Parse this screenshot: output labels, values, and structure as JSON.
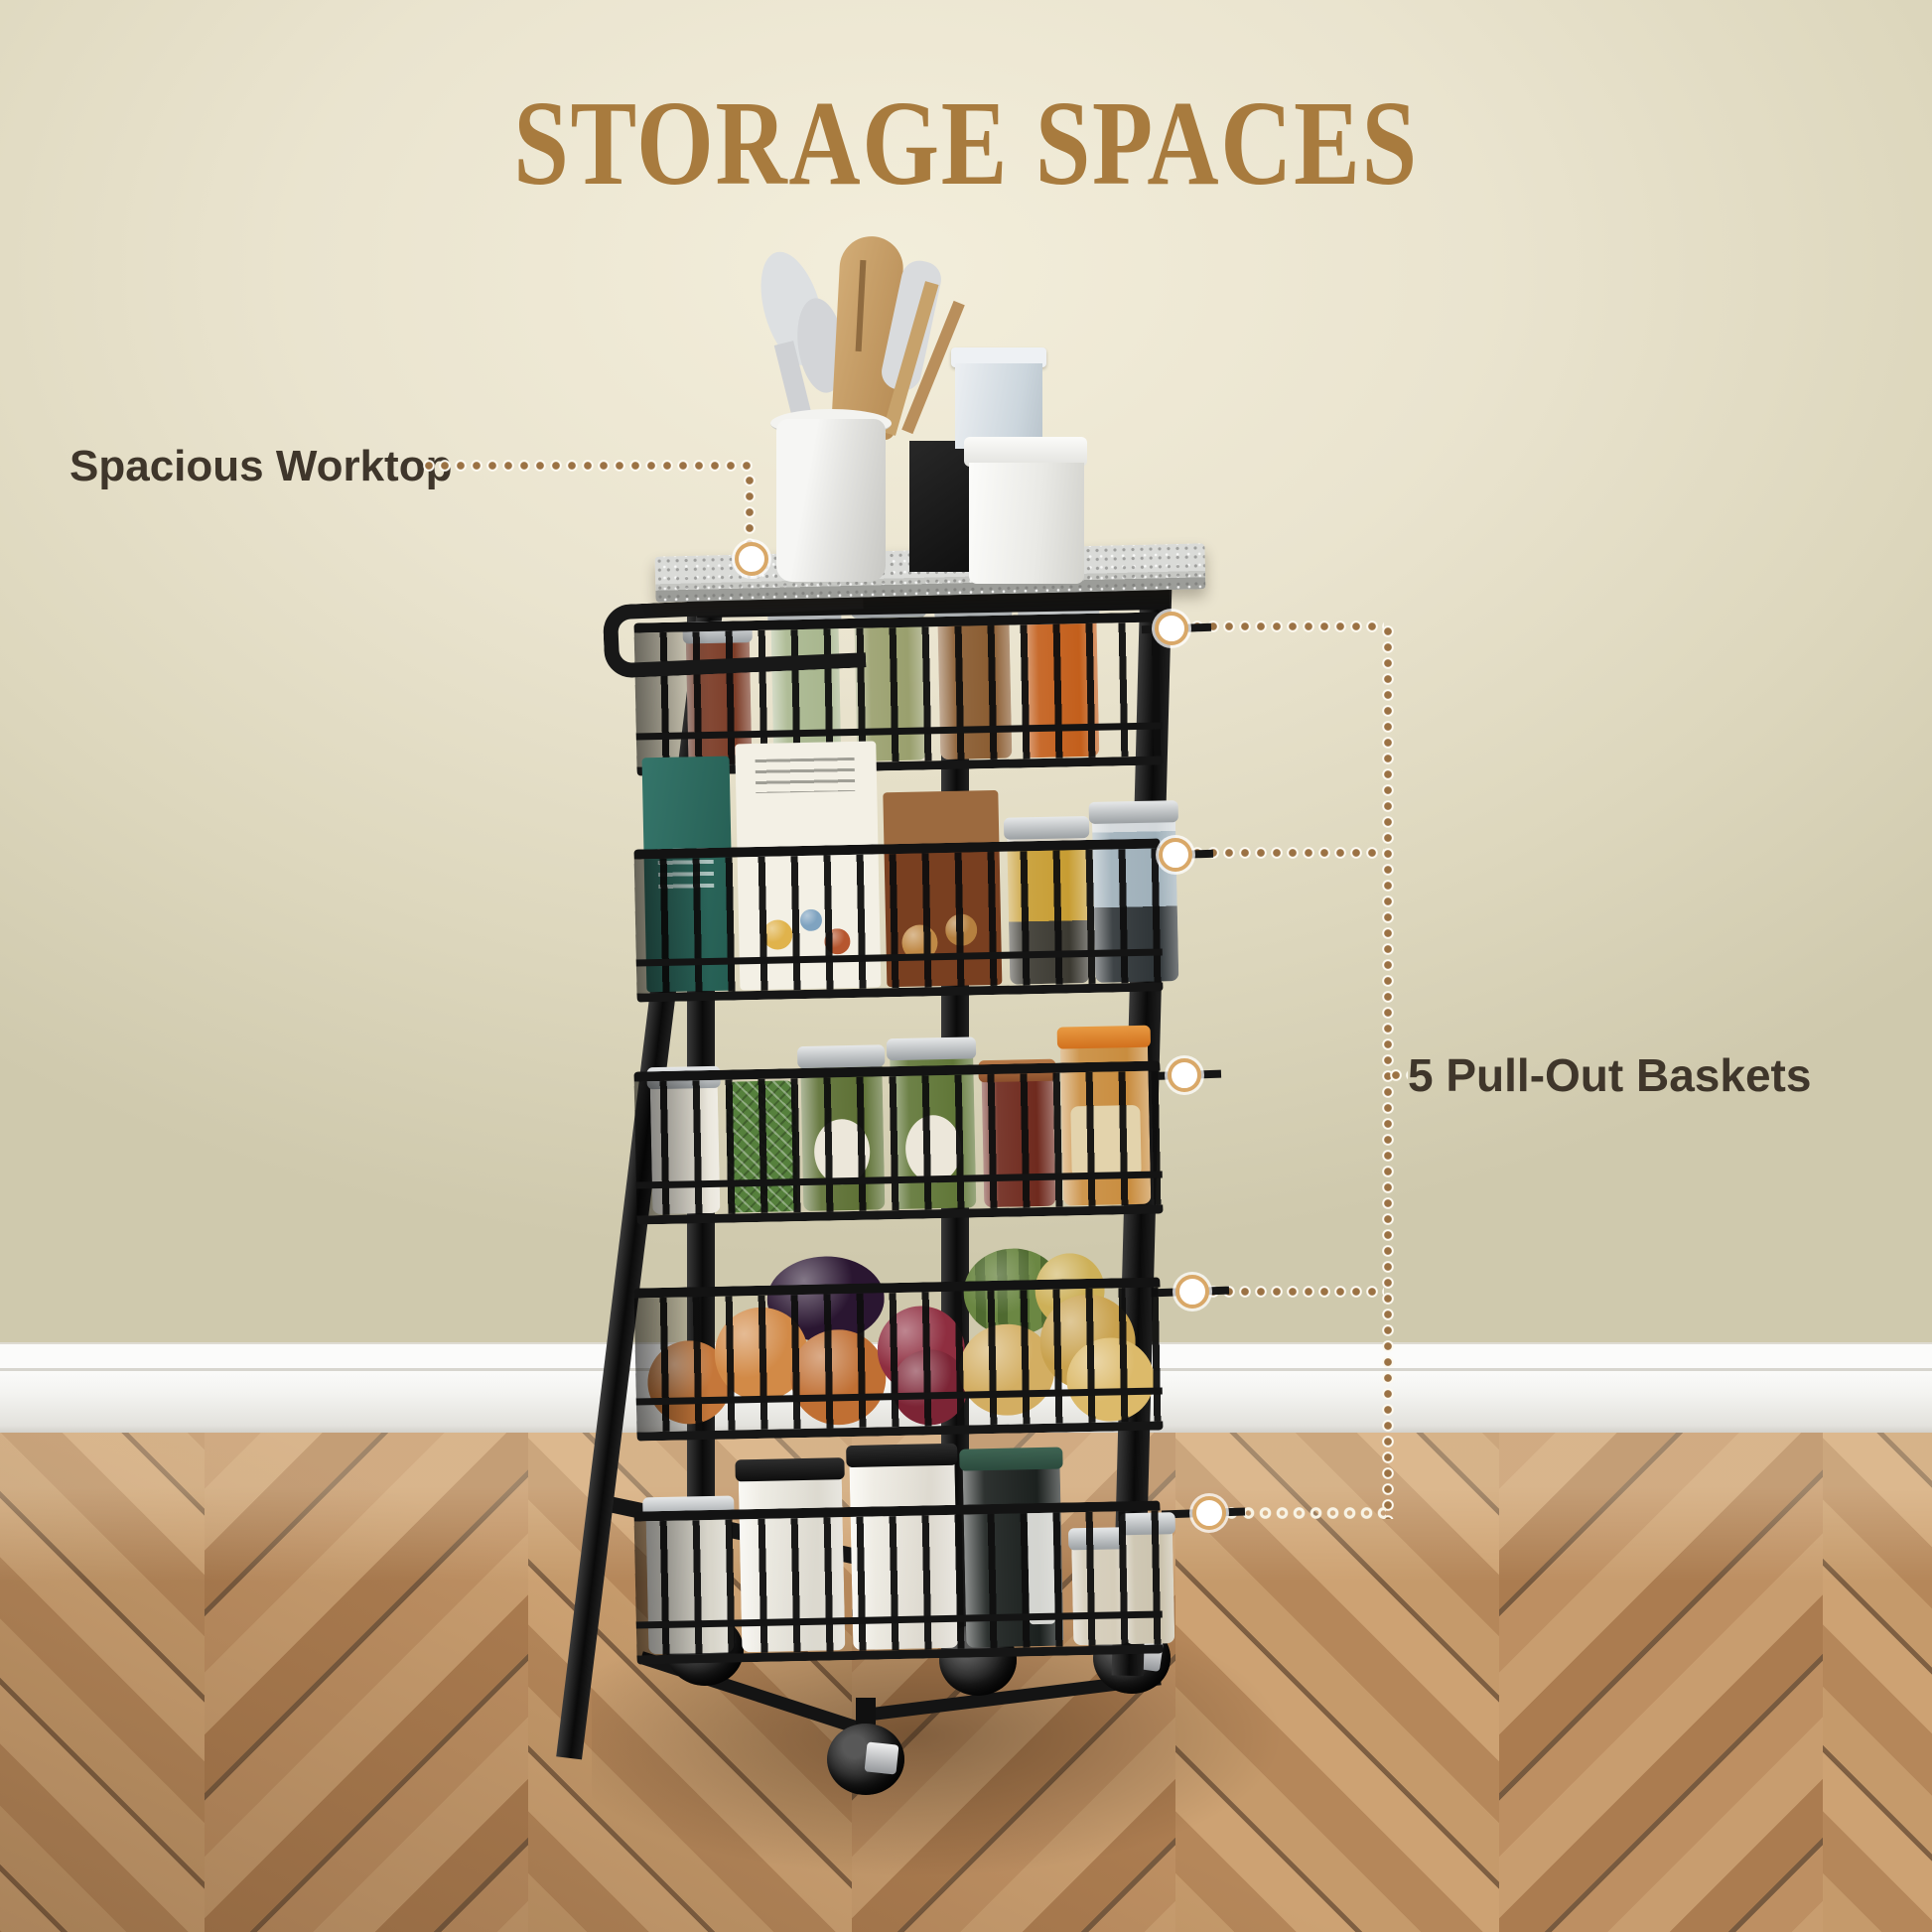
{
  "title": {
    "text": "STORAGE SPACES",
    "color": "#a87b3e"
  },
  "callouts": {
    "worktop_label": "Spacious Worktop",
    "baskets_label": "5 Pull-Out Baskets",
    "text_color": "#3f362b",
    "dot_color": "#9b7244",
    "marker_ring_color": "#d9a868"
  },
  "palette": {
    "wall": "#eae4cf",
    "baseboard": "#f3f3f0",
    "floor_wood": "#bd8f61",
    "cart_metal": "#141414",
    "worktop_granite": "#cdcecb"
  }
}
